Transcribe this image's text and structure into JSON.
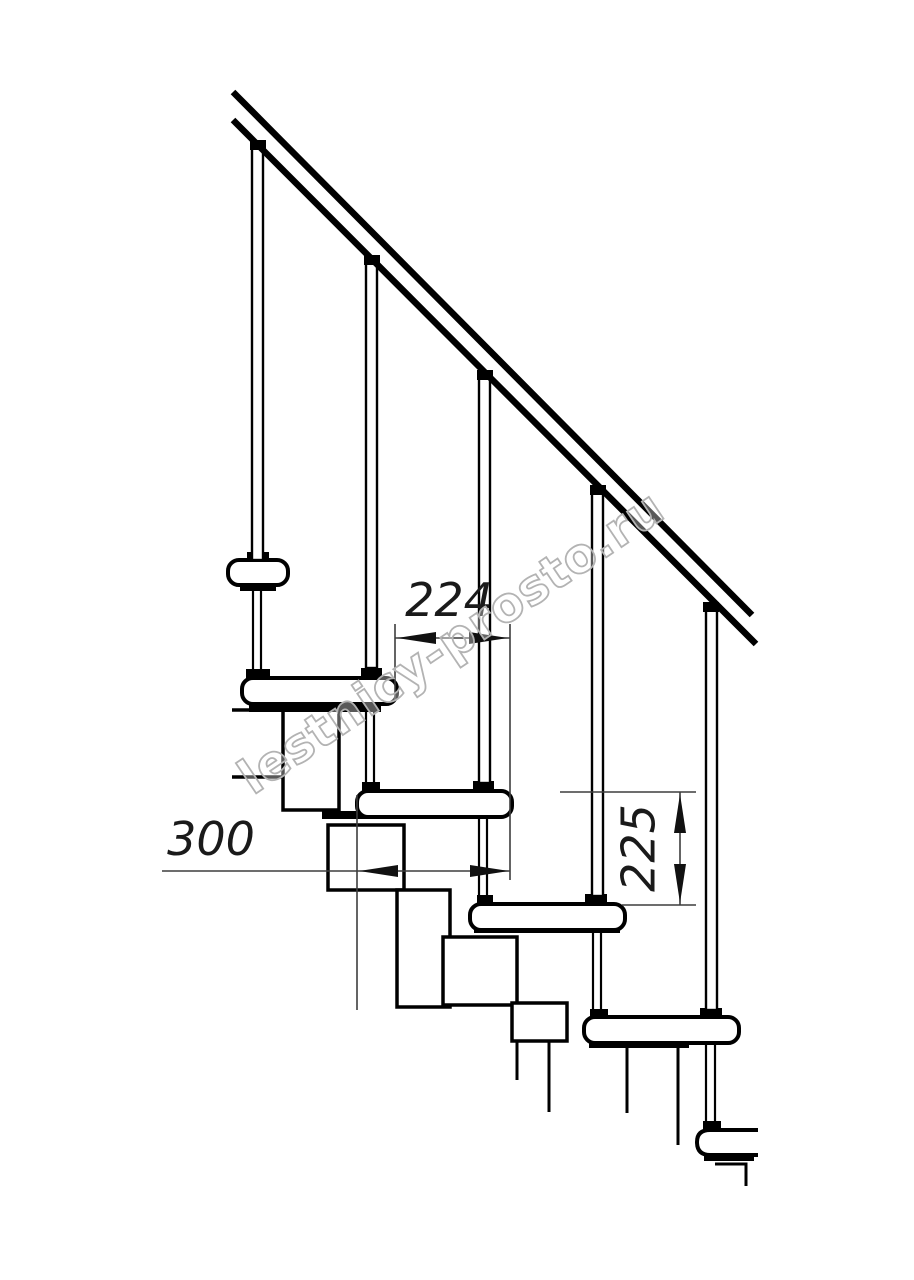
{
  "document": {
    "kind": "modular staircase side-view technical drawing fragment",
    "background": "#ffffff",
    "ink_color": "#000000",
    "dim_color": "#3d3d3d"
  },
  "watermark": {
    "text": "lestnicy-prosto.ru",
    "stroke_color": "#b3b3b3"
  },
  "dimensions": {
    "step_run": {
      "value": "224",
      "orientation": "horizontal"
    },
    "tread_depth": {
      "value": "300",
      "orientation": "horizontal"
    },
    "riser_height": {
      "value": "225",
      "orientation": "vertical"
    }
  },
  "structure": {
    "balusters": 5,
    "treads": 6
  }
}
